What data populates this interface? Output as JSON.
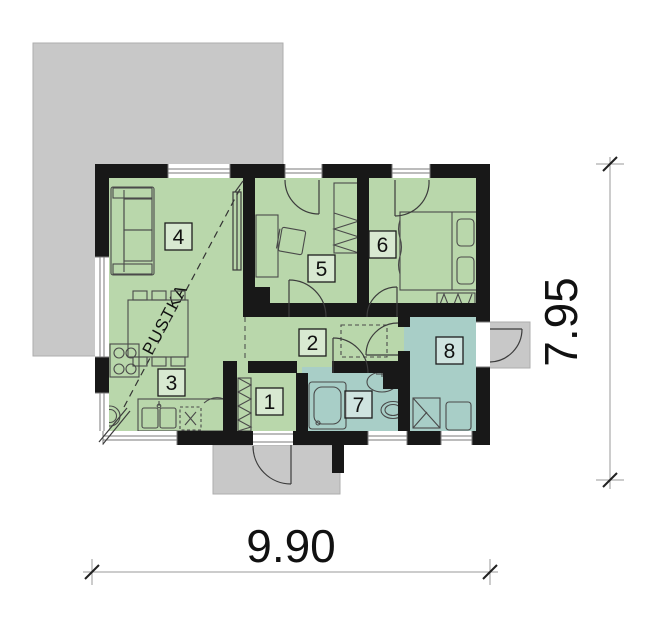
{
  "plan": {
    "room_labels": {
      "r1": "1",
      "r2": "2",
      "r3": "3",
      "r4": "4",
      "r5": "5",
      "r6": "6",
      "r7": "7",
      "r8": "8"
    },
    "void_label": "PUSTKA"
  },
  "dimensions": {
    "width_label": "9.90",
    "height_label": "7.95"
  },
  "colors": {
    "wall": "#181818",
    "room_green": "#b9d7ab",
    "room_teal": "#a8cec7",
    "outdoor_gray": "#c8c8c8",
    "furniture_line": "#4a4a4a"
  }
}
